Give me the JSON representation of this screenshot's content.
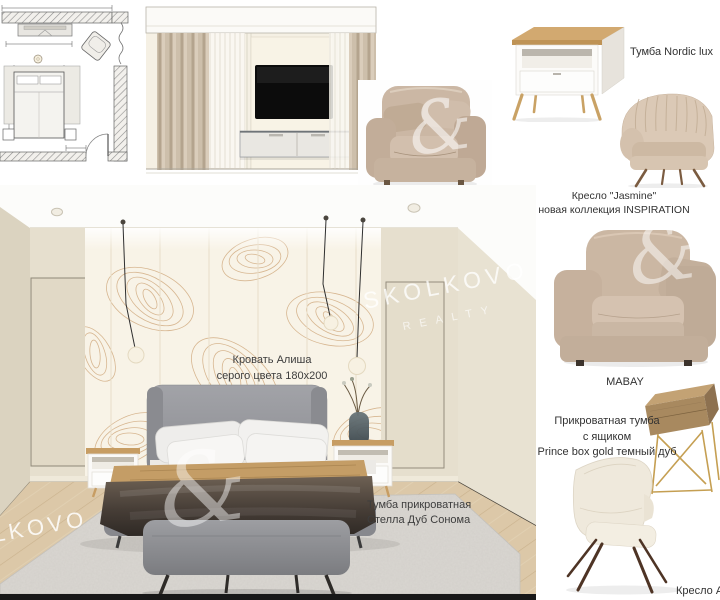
{
  "labels": {
    "nordic": "Тумба Nordic lux",
    "jasmine_line1": "Кресло \"Jasmine\"",
    "jasmine_line2": "новая коллекция INSPIRATION",
    "mabay": "MABAY",
    "prince_line1": "Прикроватная тумба",
    "prince_line2": "с ящиком",
    "prince_line3": "Prince box gold темный дуб",
    "kreslo_a": "Кресло А",
    "bed_line1": "Кровать Алиша",
    "bed_line2": "серого цвета 180x200",
    "stella_line1": "Тумба прикроватная",
    "stella_line2": "Стелла Дуб Сонома"
  },
  "watermark": {
    "brand": "SKOLKOVO",
    "subtitle": "REALTY",
    "brand_partial": "LKOVO",
    "monogram": "&"
  },
  "colors": {
    "wall_beige": "#e6dfce",
    "wallpaper": "#f8f3e7",
    "wallpaper_line": "#cfa87c",
    "curtain": "#c4b5a1",
    "bed_gray": "#97989d",
    "bedspread_dark": "#3f3832",
    "throw_camel": "#c49d66",
    "bench_gray": "#8f9094",
    "rug_gray": "#dad7d2",
    "floor_wood": "#dcc8a8",
    "wood_top": "#c79d63",
    "armchair_beige": "#cbb7a3",
    "gold": "#c59f52",
    "label_text": "#323232"
  }
}
